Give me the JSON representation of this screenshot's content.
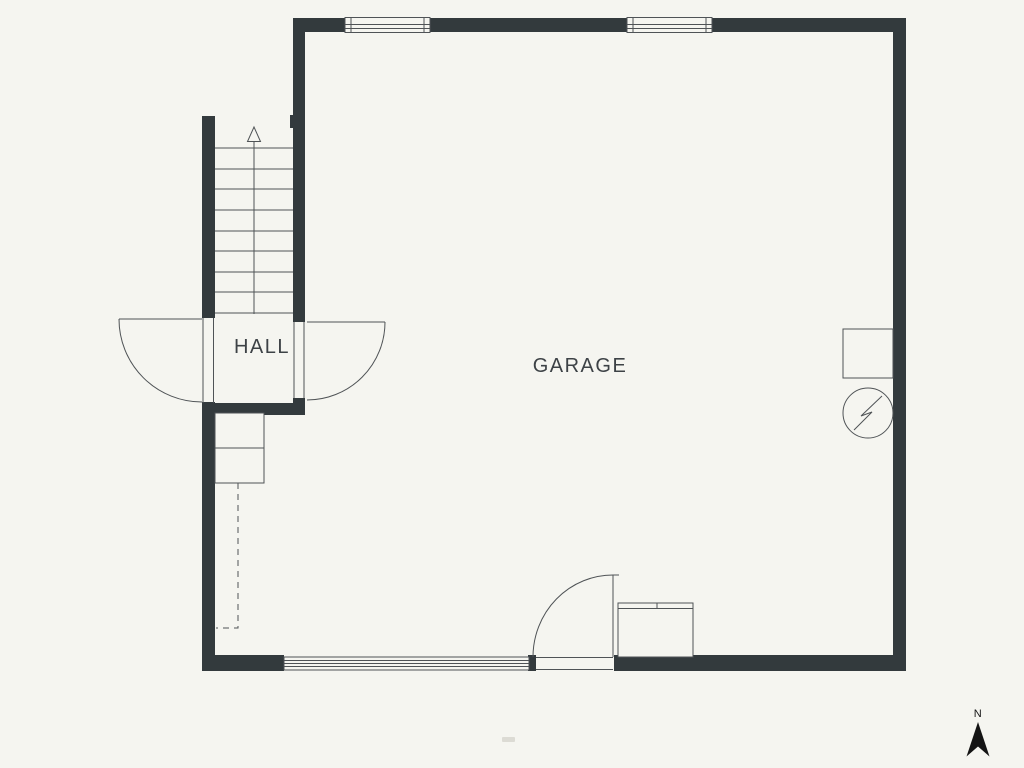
{
  "colors": {
    "background": "#f5f5f0",
    "wall": "#333a3d",
    "line": "#4f5356",
    "text": "#3d4246",
    "north": "#141414",
    "watermark": "#b7b4ab"
  },
  "labels": {
    "hall": "HALL",
    "garage": "GARAGE",
    "compass_north": "N"
  },
  "fixtures": {
    "stairs_arrow_icon": "up-arrow",
    "electrical_icon": "circle-lightning-bolt",
    "north_icon": "north-compass-arrow",
    "window_icon": "double-pane-window",
    "garage_door_icon": "sectional-door-band",
    "swing_door_icon": "quarter-circle-door-swing"
  }
}
